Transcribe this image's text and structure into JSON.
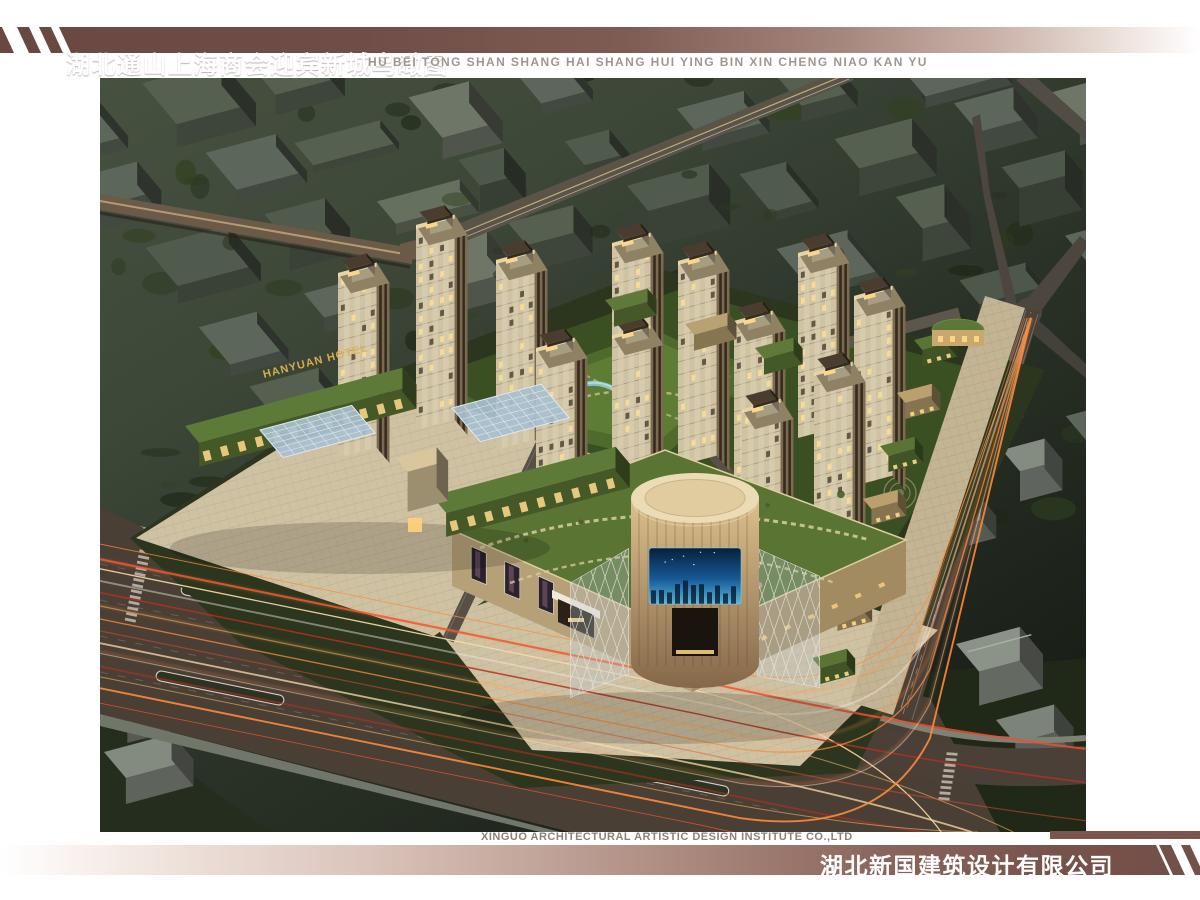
{
  "header": {
    "title": "湖北通山上海商会迎宾新城鸟瞰图",
    "subtitle_pinyin": "HU BEI TONG SHAN SHANG HAI SHANG HUI YING BIN XIN CHENG NIAO KAN YU"
  },
  "footer": {
    "company_en": "XINGUO ARCHITECTURAL ARTISTIC DESIGN INSTITUTE CO.,LTD",
    "company_cn": "湖北新国建筑设计有限公司"
  },
  "scene": {
    "hotel_sign": "HANYUAN HOTEL",
    "colors": {
      "banner_maroon": "#6f4e47",
      "pinyin_grey": "#a1968f",
      "footer_en_grey": "#8b817a",
      "sign_gold": "#e0b252",
      "led_screen_blue": "#155a96",
      "roof_lawn_green": "#5a7434",
      "site_lawn_green": "#3a5022",
      "paving_beige": "#cfc2a3",
      "asphalt_brown": "#4a3f35",
      "light_trail_orange": "#ff8a3a",
      "light_trail_red": "#ef4e2e",
      "light_trail_cream": "#ffd9a6",
      "tree_green": "#4a6e2e",
      "umbrella_red": "#a73a2a",
      "context_olive": "#566050",
      "glass_blue": "#a9c0cf",
      "tower_beige": "#cfc3a4",
      "window_gold": "#f8dc96"
    }
  }
}
